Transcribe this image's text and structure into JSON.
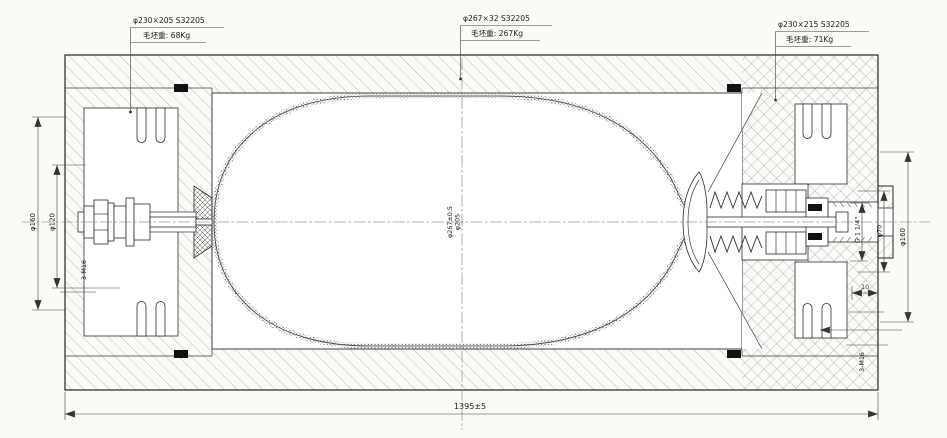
{
  "drawing": {
    "callouts": [
      {
        "spec": "φ230×205 S32205",
        "weight": "毛坯重: 68Kg"
      },
      {
        "spec": "φ267×32 S32205",
        "weight": "毛坯重: 267Kg"
      },
      {
        "spec": "φ230×215 S32205",
        "weight": "毛坯重: 71Kg"
      }
    ],
    "dims": {
      "left_boss_dia": "φ160",
      "left_bolt_circle": "φ120",
      "left_stud_thread": "3-M16",
      "shell_od": "φ267±0.5",
      "shell_id": "φ205",
      "port_thread": "G 1 1/4\"",
      "port_bore": "φ70",
      "right_boss_dia": "φ160",
      "boss_offset": "10",
      "right_stud_thread": "3-M16",
      "overall_length": "1395±5"
    },
    "colors": {
      "line": "#2b2b2b",
      "hatch": "#8a8a8a",
      "paper": "#fbfaf7"
    }
  }
}
